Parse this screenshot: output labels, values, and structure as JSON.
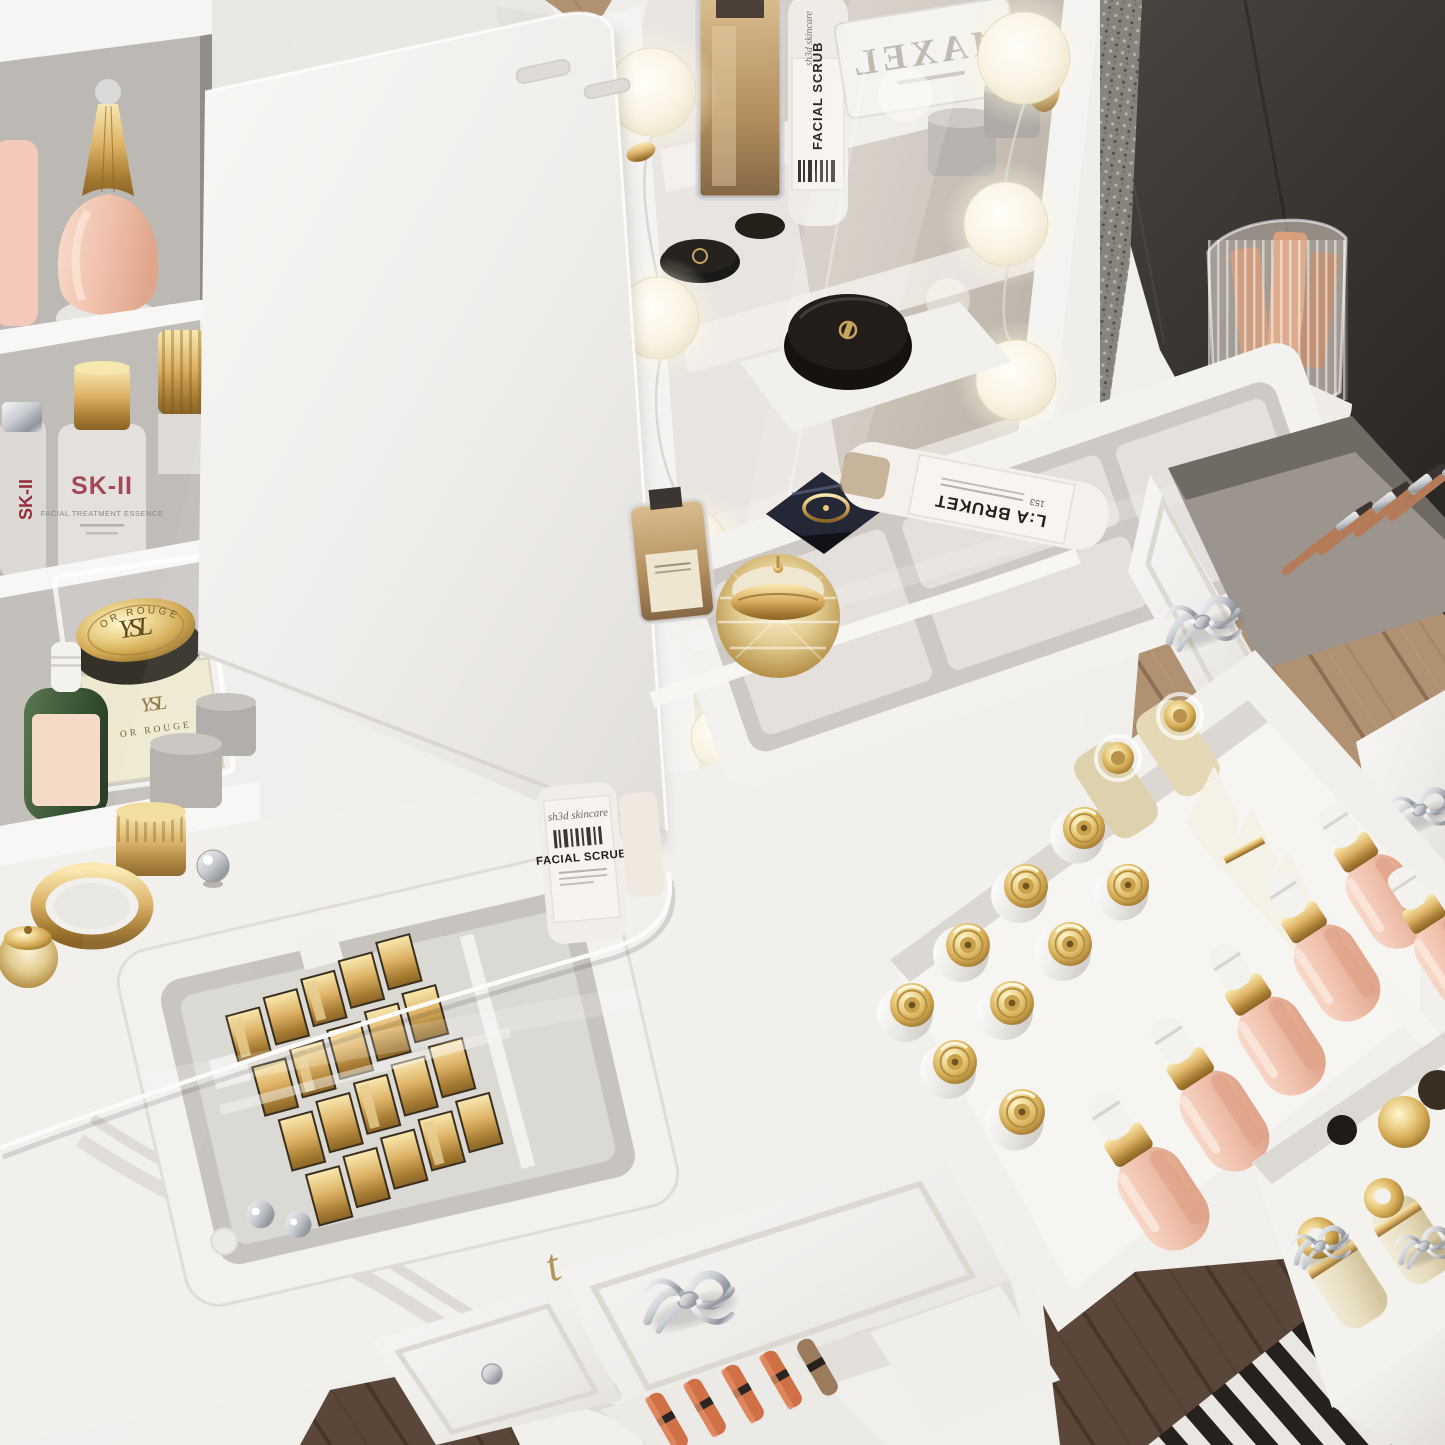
{
  "meta": {
    "subject": "White French-style vanity dressing table with lighted mirror, glass-top organizers, cosmetics and open drawers",
    "view": "high-angle 3/4 top-down product render"
  },
  "palette": {
    "furniture_white": "#f3f1ee",
    "wall_charcoal": "#3a3632",
    "wood_light": "#b09070",
    "wood_dark": "#5b473a",
    "rug_black": "#24211e",
    "rug_white": "#eae7e2",
    "gold": "#d3a952",
    "blush_pink": "#efc0ab",
    "cream": "#e6dbbd",
    "silver": "#c9ccd1",
    "mirror_warm_gray": "#cfc7bd"
  },
  "labels": {
    "sk2_name": "SK-II",
    "sk2_sub": "FACIAL TREATMENT ESSENCE",
    "ysl_monogram": "YSL",
    "ysl_line": "OR ROUGE",
    "scrub_script": "sh3d skincare",
    "scrub_title": "FACIAL SCRUB",
    "labruket_name": "L:A BRUKET",
    "labruket_no": "153",
    "maxel_name": "MAXEL",
    "engraved_t": "t",
    "engraved_o": "o"
  },
  "inventory": {
    "mirror_bulbs": 7,
    "gold_cap_white_bottles": 9,
    "pink_dropper_bottles": 6,
    "white_wedge_tubes": 3,
    "gold_lipstick_cases": 20,
    "silver_bullet_cases": 2,
    "orange_lipsticks": 5,
    "makeup_brushes": 4,
    "cream_pump_bottles": 2,
    "ornate_silver_handles": 7,
    "glass_top_compartments": 2
  }
}
